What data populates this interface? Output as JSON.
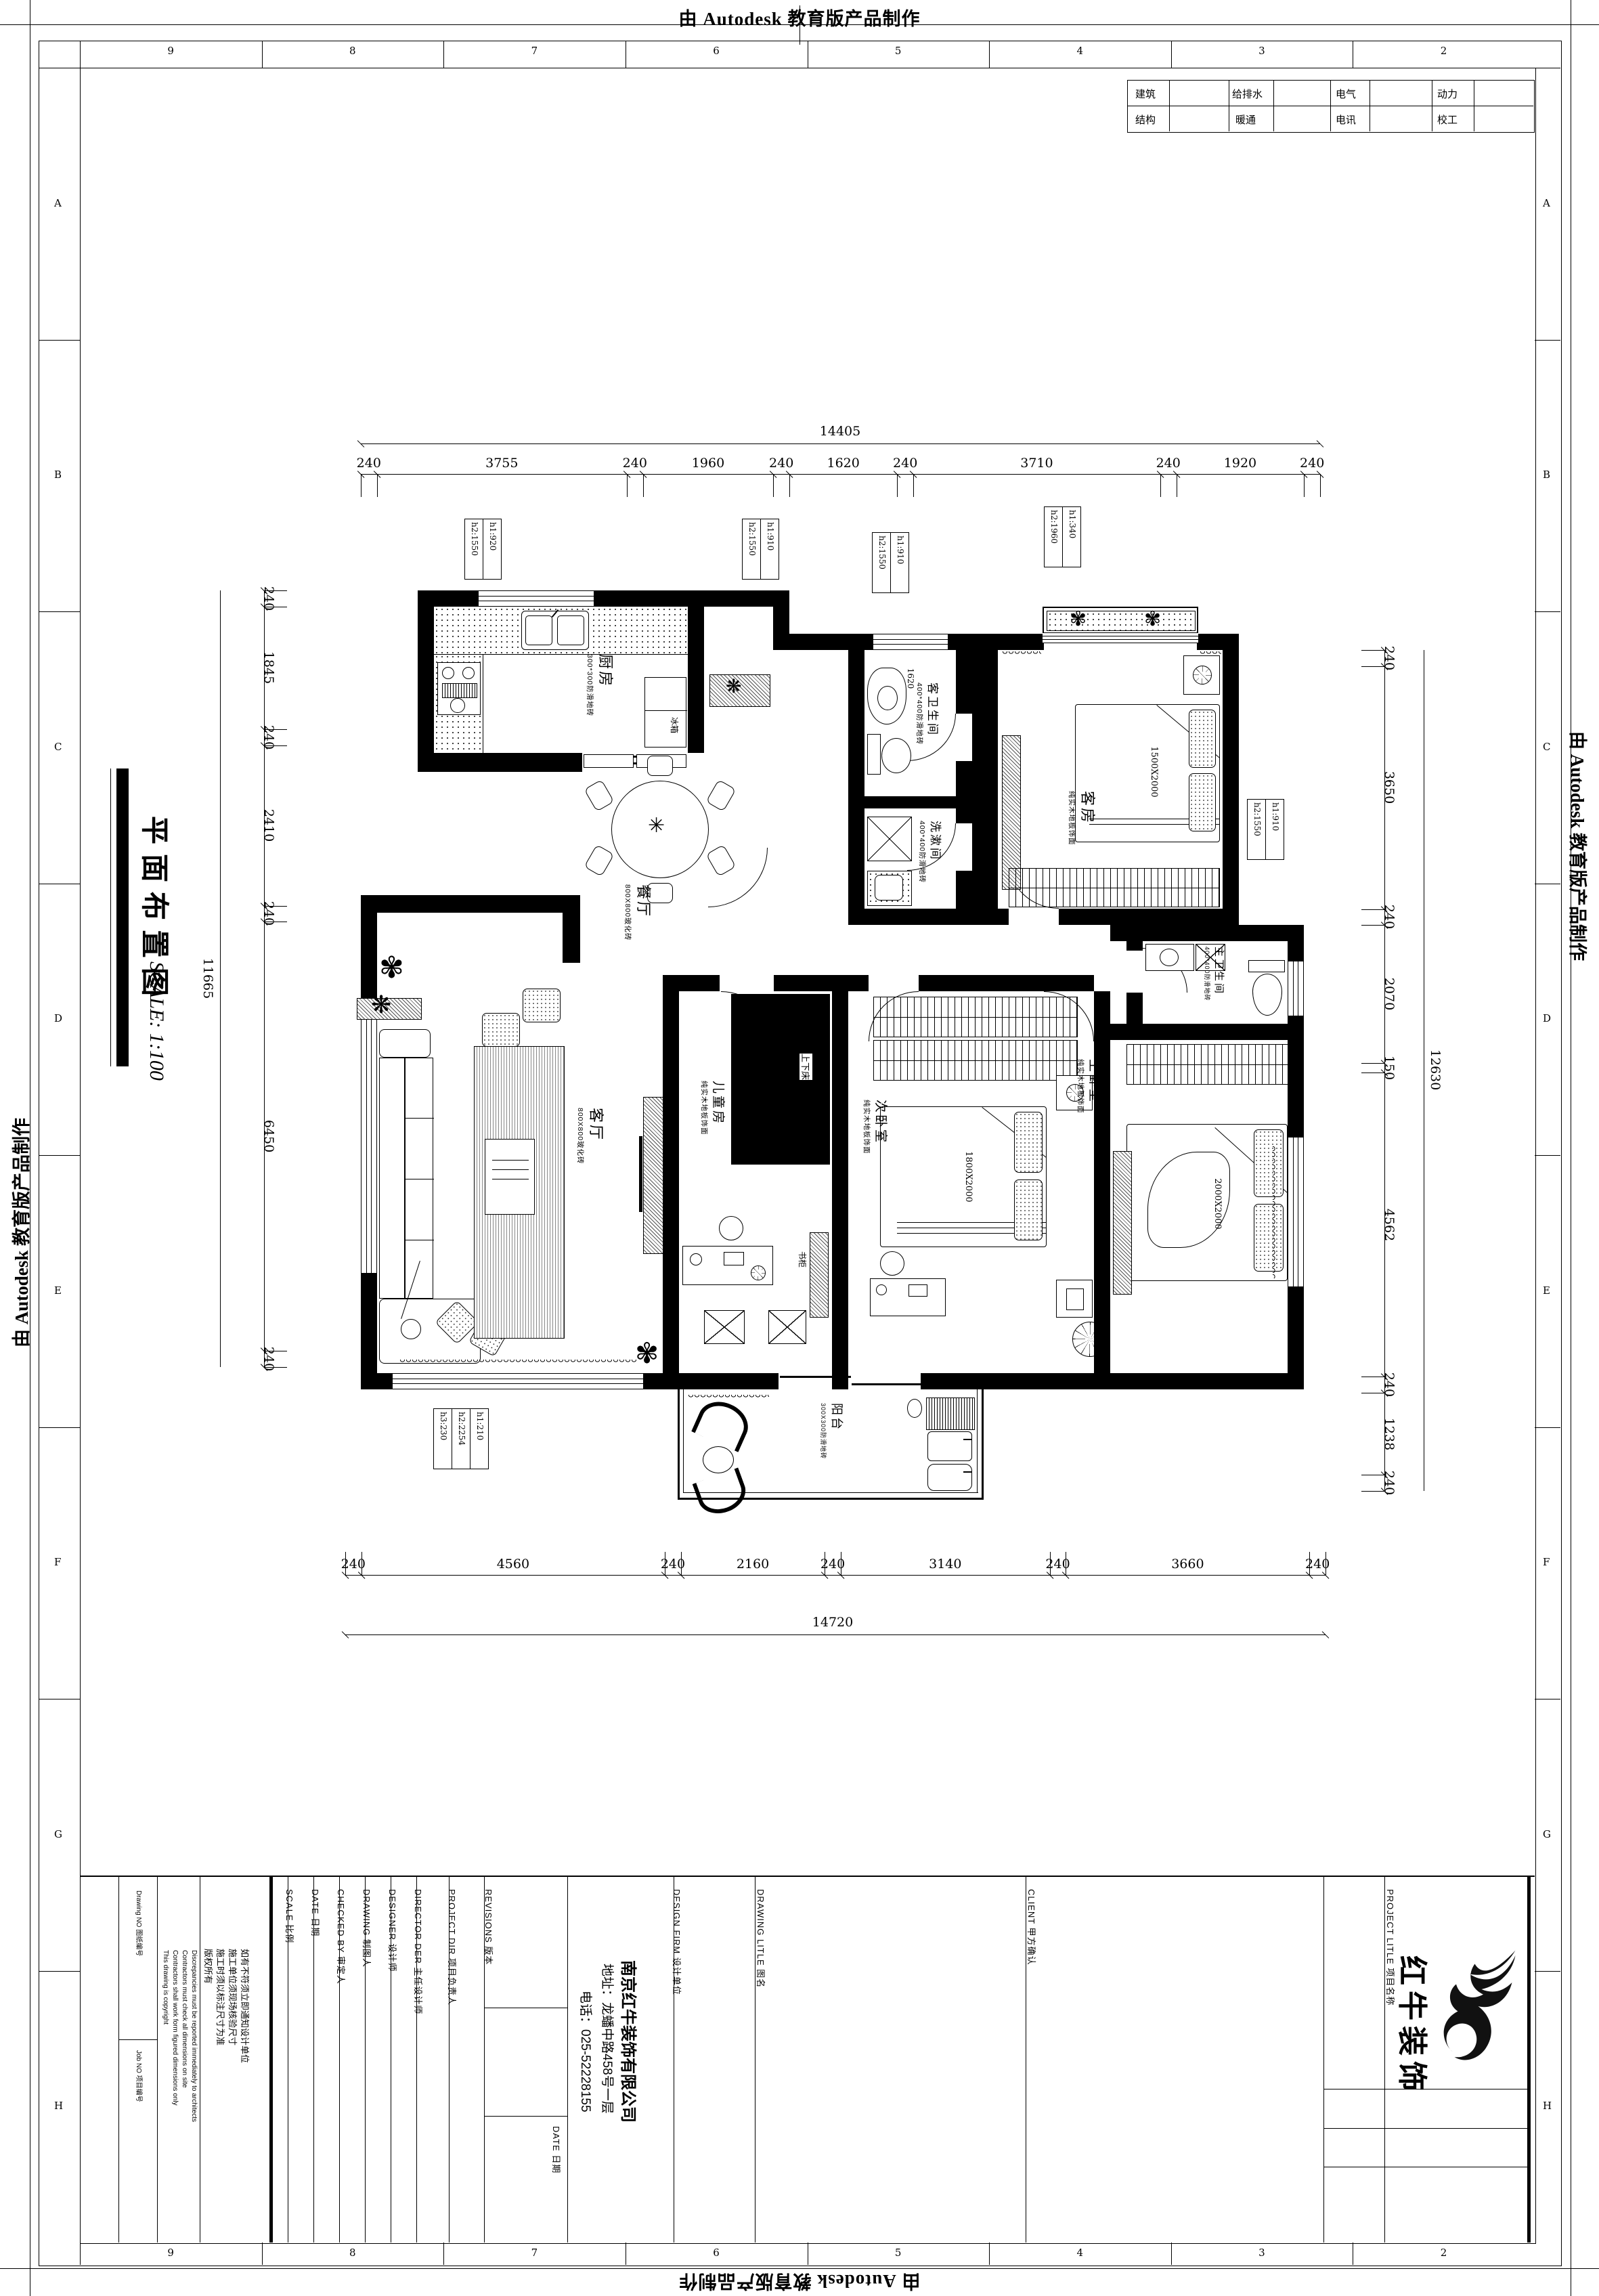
{
  "banner": {
    "text": "由 Autodesk 教育版产品制作"
  },
  "grid": {
    "cols": [
      "9",
      "8",
      "7",
      "6",
      "5",
      "4",
      "3",
      "2"
    ],
    "rows": [
      "A",
      "B",
      "C",
      "D",
      "E",
      "F",
      "G",
      "H"
    ]
  },
  "consultant": {
    "rows": [
      [
        "建筑",
        "给排水",
        "电气",
        "动力"
      ],
      [
        "结构",
        "暖通",
        "电讯",
        "校工"
      ]
    ]
  },
  "sheet_title": {
    "name": "平面布置图",
    "scale": "SCALE: 1:100"
  },
  "dims": {
    "top": {
      "total": "14405",
      "segments": [
        "240",
        "3755",
        "240",
        "1960",
        "240",
        "1620",
        "240",
        "3710",
        "240",
        "1920",
        "240"
      ]
    },
    "bottom": {
      "total": "14720",
      "segments": [
        "240",
        "4560",
        "240",
        "2160",
        "240",
        "3140",
        "240",
        "3660",
        "240"
      ]
    },
    "left": {
      "total": "11665",
      "segments": [
        "240",
        "1845",
        "240",
        "2410",
        "240",
        "6450",
        "240"
      ]
    },
    "right": {
      "total": "12630",
      "segments": [
        "240",
        "3650",
        "240",
        "2070",
        "150",
        "4562",
        "240",
        "1238",
        "240"
      ]
    }
  },
  "rooms": {
    "kitchen": {
      "label": "厨房",
      "note": "300*300防滑地砖"
    },
    "dining": {
      "label": "餐厅",
      "note": "800X800玻化砖"
    },
    "living": {
      "label": "客厅",
      "note": "800X800玻化砖"
    },
    "guest_bath": {
      "label": "客卫生间",
      "note": "400*400防滑地砖"
    },
    "wash": {
      "label": "洗漱间",
      "note": "400*400防滑地砖"
    },
    "guest_room": {
      "label": "客房",
      "note": "纯实木地板饰面"
    },
    "children": {
      "label": "儿童房",
      "note": "纯实木地板饰面"
    },
    "second_bed": {
      "label": "次卧室",
      "note": "纯实木地板饰面"
    },
    "master_bath": {
      "label": "主卫生间",
      "note": "400*400防滑地砖"
    },
    "master_bed": {
      "label": "主卧室",
      "note": "纯实木地板饰面"
    },
    "balcony": {
      "label": "阳台",
      "note": "300X300防滑地砖"
    }
  },
  "furniture": {
    "fridge": "冰箱",
    "bookcase": "书柜",
    "bunk": "上下床"
  },
  "beds": {
    "guest": "1500X2000",
    "second": "1800X2000",
    "master": "2000X2000"
  },
  "inner_dims": {
    "bath": "1620",
    "children": "2000"
  },
  "tags": {
    "t1": [
      "h1:920",
      "h2:1550"
    ],
    "t2": [
      "h1:910",
      "h2:1550"
    ],
    "t3": [
      "h1:910",
      "h2:1550"
    ],
    "t4": [
      "h1:340",
      "h2:1960"
    ],
    "t5": [
      "h1:910",
      "h2:1550"
    ],
    "t6": [
      "h1:210",
      "h2:2254",
      "h3:230"
    ]
  },
  "titleblock": {
    "drawing_no": "Drawing NO  图纸编号",
    "job_no": "Job NO  项目编号",
    "notes_en": [
      "This drawing is copyright",
      "Contractors shall work form figured dimensions only",
      "Contractors must check all dimensions on site",
      "Discrepancies must be reported immediately to architects"
    ],
    "notes_cn": [
      "版权所有",
      "施工时须以标注尺寸为准",
      "施工单位须现场核验尺寸",
      "如有不符须立即通知设计单位"
    ],
    "scale": "SCALE  比例",
    "date": "DATE  日期",
    "checked": "CHECKED BY  审定人",
    "drawing": "DRAWING  制图人",
    "designer": "DESIGNER  设计师",
    "director": "DIRECTOR DER  主任设计师",
    "project_dir": "PROJECT DIR  项目负责人",
    "revisions": "REVISIONS  版本",
    "rev_date": "DATE  日期",
    "design_firm": "DESIGN FIRM  设计单位",
    "company": [
      "南京红牛装饰有限公司",
      "地址：龙蟠中路458号一层",
      "电话：025-52228155"
    ],
    "drawing_title": "DRAWING LITLE  图名",
    "client": "CLIENT  甲方确认",
    "project_title": "PROJECT LITLE  项目名称"
  },
  "logo": {
    "text": "红牛装饰"
  }
}
